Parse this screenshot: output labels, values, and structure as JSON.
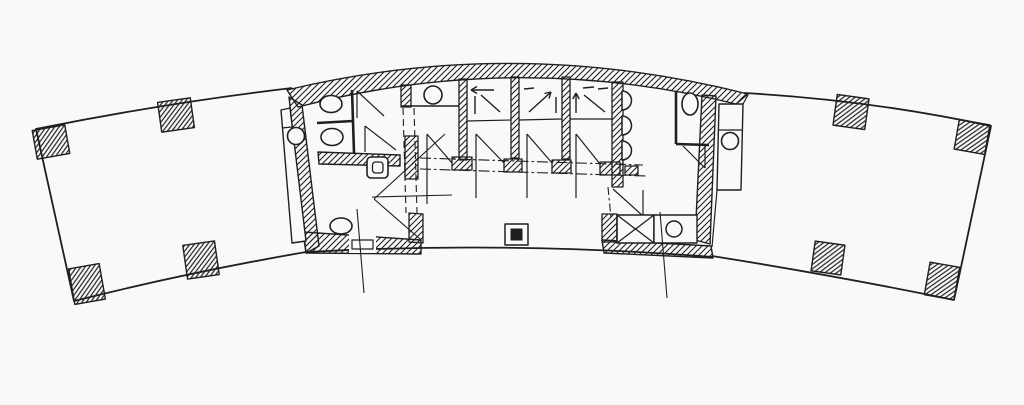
{
  "meta": {
    "type": "architectural-floor-plan",
    "description": "Hand-drafted scanned floor plan of a curved arc-shaped building: open east and west wings with hatched structural columns, and a central service core containing toilet rooms, three elevators with directional arrows, urinals, a duct shaft and service closets.",
    "canvas": {
      "width": 1024,
      "height": 405
    },
    "colors": {
      "ink": "#1f1f1f",
      "paper": "#f9f9f7"
    }
  },
  "legend": {
    "wing_columns": 8,
    "round_columns": 2,
    "elevators": 3,
    "toilets": 4,
    "urinals": 3,
    "basins": 2,
    "duct_shafts": 1,
    "closets": 1
  },
  "shapes": [
    {
      "name": "left-wing-outline",
      "kind": "path",
      "d": "M292,88 Q165,103 36,129 L74,301 Q190,272 306,252",
      "sw": 1.8
    },
    {
      "name": "right-wing-outline",
      "kind": "path",
      "d": "M744,93 Q870,100 991,126 L954,300 Q838,276 712,256",
      "sw": 1.8
    },
    {
      "name": "building-south-edge",
      "kind": "path",
      "d": "M306,252 Q510,241 713,257",
      "sw": 1.8
    },
    {
      "name": "structural-column",
      "kind": "rect",
      "x": 34.5,
      "y": 127.5,
      "w": 33,
      "h": 29,
      "rot": -10,
      "fill": "hatch2",
      "sw": 1.4
    },
    {
      "name": "structural-column",
      "kind": "rect",
      "x": 159.5,
      "y": 100,
      "w": 33,
      "h": 30,
      "rot": -8,
      "fill": "hatch2",
      "sw": 1.4
    },
    {
      "name": "structural-column",
      "kind": "rect",
      "x": 71.5,
      "y": 266,
      "w": 31,
      "h": 36,
      "rot": -10,
      "fill": "hatch2",
      "sw": 1.4
    },
    {
      "name": "structural-column",
      "kind": "rect",
      "x": 185,
      "y": 243,
      "w": 32,
      "h": 34,
      "rot": -8,
      "fill": "hatch2",
      "sw": 1.4
    },
    {
      "name": "structural-column",
      "kind": "rect",
      "x": 835,
      "y": 96.5,
      "w": 32,
      "h": 31,
      "rot": 8,
      "fill": "hatch2",
      "sw": 1.4
    },
    {
      "name": "structural-column",
      "kind": "rect",
      "x": 956.5,
      "y": 122,
      "w": 31,
      "h": 30,
      "rot": 10,
      "fill": "hatch2",
      "sw": 1.4
    },
    {
      "name": "structural-column",
      "kind": "rect",
      "x": 813,
      "y": 243,
      "w": 30,
      "h": 30,
      "rot": 8,
      "fill": "hatch2",
      "sw": 1.4
    },
    {
      "name": "structural-column",
      "kind": "rect",
      "x": 927,
      "y": 264.5,
      "w": 30,
      "h": 33,
      "rot": 10,
      "fill": "hatch2",
      "sw": 1.4
    },
    {
      "name": "core-north-wall",
      "kind": "path",
      "d": "M287,90 Q515,35 748,94 L736,104 Q515,50 298,107 Z",
      "fill": "hatch",
      "sw": 1.4
    },
    {
      "name": "core-west-wall",
      "kind": "path",
      "d": "M289,97 L302,105 L319,246 L306,253 Z",
      "fill": "hatch",
      "sw": 1.4
    },
    {
      "name": "core-east-wall",
      "kind": "path",
      "d": "M702,95 L716,96 L710,244 L695,240 Z",
      "fill": "hatch",
      "sw": 1.4
    },
    {
      "name": "core-south-wall-west",
      "kind": "path",
      "d": "M303,232 L421,240 L421,254 L306,253 Z",
      "fill": "hatch",
      "sw": 1.4
    },
    {
      "name": "core-south-wall-east",
      "kind": "path",
      "d": "M602,240 L711,246 L713,258 L604,253 Z",
      "fill": "hatch",
      "sw": 1.4
    },
    {
      "name": "wc-partition-wall",
      "kind": "path",
      "d": "M318,152 L400,155 L400,166 L319,164 Z",
      "fill": "hatch",
      "sw": 1.4
    },
    {
      "name": "pier-service-room",
      "kind": "path",
      "d": "M401,85 L411,85 L411,107 L401,107 Z",
      "fill": "hatch",
      "sw": 1.3
    },
    {
      "name": "pier-lobby-west",
      "kind": "path",
      "d": "M405,136 L418,136 L418,179 L405,179 Z",
      "fill": "hatch",
      "sw": 1.3
    },
    {
      "name": "pier-lobby-south",
      "kind": "path",
      "d": "M409,213 L423,214 L423,243 L409,242 Z",
      "fill": "hatch",
      "sw": 1.3
    },
    {
      "name": "elevator-pier",
      "kind": "rect",
      "x": 459,
      "y": 79,
      "w": 8,
      "h": 81,
      "fill": "hatch",
      "sw": 1.3
    },
    {
      "name": "elevator-pier",
      "kind": "rect",
      "x": 511,
      "y": 77,
      "w": 8,
      "h": 81,
      "fill": "hatch",
      "sw": 1.3
    },
    {
      "name": "elevator-pier",
      "kind": "rect",
      "x": 562,
      "y": 77,
      "w": 8,
      "h": 82,
      "fill": "hatch",
      "sw": 1.3
    },
    {
      "name": "mens-west-wall",
      "kind": "rect",
      "x": 612,
      "y": 82,
      "w": 11,
      "h": 105,
      "fill": "hatch",
      "sw": 1.3
    },
    {
      "name": "pier-duct",
      "kind": "rect",
      "x": 602,
      "y": 214,
      "w": 15,
      "h": 28,
      "fill": "hatch",
      "sw": 1.3
    },
    {
      "name": "door-gap",
      "kind": "rect",
      "x": 349,
      "y": 231,
      "w": 27,
      "h": 22,
      "fill": "paper"
    },
    {
      "name": "door-threshold",
      "kind": "rect",
      "x": 352,
      "y": 240,
      "w": 21,
      "h": 9,
      "fill": "paper",
      "sw": 1.2
    },
    {
      "name": "west-service-strip",
      "kind": "path",
      "d": "M281,110 L290,108 L306,241 L292,243 Z",
      "fill": "paper",
      "sw": 1.4
    },
    {
      "name": "west-strip-divider",
      "kind": "line",
      "x1": 282,
      "y1": 128,
      "x2": 292,
      "y2": 127,
      "sw": 1.2
    },
    {
      "name": "east-service-strip",
      "kind": "path",
      "d": "M719,104 L743,104 L741,190 L717,190 Z",
      "fill": "paper",
      "sw": 1.4
    },
    {
      "name": "east-strip-divider",
      "kind": "line",
      "x1": 719,
      "y1": 130,
      "x2": 742,
      "y2": 130,
      "sw": 1.2
    },
    {
      "name": "east-strip-top-link",
      "kind": "line",
      "x1": 743,
      "y1": 104,
      "x2": 748,
      "y2": 95,
      "sw": 1.2
    },
    {
      "name": "east-strip-bottom-link",
      "kind": "line",
      "x1": 717,
      "y1": 190,
      "x2": 712,
      "y2": 247,
      "sw": 1.2
    },
    {
      "name": "round-column",
      "kind": "circle",
      "cx": 296,
      "cy": 136,
      "r": 8.5,
      "fill": "paper",
      "sw": 1.6
    },
    {
      "name": "round-column",
      "kind": "circle",
      "cx": 730,
      "cy": 141,
      "r": 8.5,
      "fill": "paper",
      "sw": 1.6
    },
    {
      "name": "stall-front-partition",
      "kind": "line",
      "x1": 352,
      "y1": 90,
      "x2": 354,
      "y2": 153,
      "sw": 2.6
    },
    {
      "name": "stall-partition",
      "kind": "line",
      "x1": 317,
      "y1": 123,
      "x2": 353,
      "y2": 121,
      "sw": 2.6
    },
    {
      "name": "toilet",
      "kind": "ellipse",
      "cx": 331,
      "cy": 104,
      "rx": 11,
      "ry": 8.5,
      "fill": "paper",
      "sw": 1.6
    },
    {
      "name": "toilet",
      "kind": "ellipse",
      "cx": 332,
      "cy": 137,
      "rx": 11,
      "ry": 8.5,
      "fill": "paper",
      "sw": 1.6
    },
    {
      "name": "door-leaf",
      "kind": "line",
      "x1": 357,
      "y1": 91,
      "x2": 357,
      "y2": 118,
      "sw": 1.2
    },
    {
      "name": "door-swing",
      "kind": "line",
      "x1": 357,
      "y1": 91,
      "x2": 384,
      "y2": 116,
      "sw": 1.2
    },
    {
      "name": "door-leaf",
      "kind": "line",
      "x1": 365,
      "y1": 126,
      "x2": 365,
      "y2": 152,
      "sw": 1.2
    },
    {
      "name": "door-swing",
      "kind": "line",
      "x1": 365,
      "y1": 126,
      "x2": 396,
      "y2": 150,
      "sw": 1.2
    },
    {
      "name": "mop-sink",
      "kind": "rect",
      "x": 367,
      "y": 157,
      "w": 21,
      "h": 21,
      "rx": 4,
      "fill": "paper",
      "sw": 1.6
    },
    {
      "name": "mop-sink-basin",
      "kind": "rect",
      "x": 372.5,
      "y": 162,
      "w": 10.5,
      "h": 11,
      "rx": 3,
      "sw": 1.3
    },
    {
      "name": "accessible-toilet",
      "kind": "ellipse",
      "cx": 341,
      "cy": 226,
      "rx": 11,
      "ry": 8,
      "fill": "paper",
      "sw": 1.6
    },
    {
      "name": "service-room-wall",
      "kind": "line",
      "x1": 401,
      "y1": 106,
      "x2": 459,
      "y2": 106,
      "sw": 1.4
    },
    {
      "name": "wash-basin",
      "kind": "circle",
      "cx": 433,
      "cy": 95,
      "r": 9,
      "fill": "paper",
      "sw": 1.6
    },
    {
      "name": "elevator-car-line",
      "kind": "line",
      "x1": 467,
      "y1": 121,
      "x2": 511,
      "y2": 120,
      "sw": 1.2
    },
    {
      "name": "elevator-car-line",
      "kind": "line",
      "x1": 519,
      "y1": 120,
      "x2": 562,
      "y2": 119,
      "sw": 1.2
    },
    {
      "name": "elevator-car-line",
      "kind": "line",
      "x1": 570,
      "y1": 119,
      "x2": 612,
      "y2": 119,
      "sw": 1.2
    },
    {
      "name": "elevator-arrow",
      "kind": "line",
      "x1": 494,
      "y1": 90,
      "x2": 471,
      "y2": 90,
      "sw": 1.4
    },
    {
      "name": "elevator-arrow-head",
      "kind": "path",
      "d": "M471,90 L477,86.5 M471,90 L477,93.5",
      "sw": 1.4
    },
    {
      "name": "elevator-arrow",
      "kind": "line",
      "x1": 475,
      "y1": 96,
      "x2": 475,
      "y2": 114,
      "sw": 1.4
    },
    {
      "name": "elevator-arrow",
      "kind": "line",
      "x1": 481,
      "y1": 95,
      "x2": 500,
      "y2": 112,
      "sw": 1.4
    },
    {
      "name": "elevator-arrow",
      "kind": "line",
      "x1": 524,
      "y1": 89,
      "x2": 534,
      "y2": 88,
      "sw": 1.4
    },
    {
      "name": "elevator-arrow",
      "kind": "line",
      "x1": 529,
      "y1": 112,
      "x2": 551,
      "y2": 92,
      "sw": 1.4
    },
    {
      "name": "elevator-arrow-head",
      "kind": "path",
      "d": "M551,92 L544.5,93.5 M551,92 L549,98.5",
      "sw": 1.4
    },
    {
      "name": "elevator-arrow",
      "kind": "line",
      "x1": 556,
      "y1": 97,
      "x2": 556,
      "y2": 113,
      "sw": 1.4
    },
    {
      "name": "elevator-arrow",
      "kind": "line",
      "x1": 576,
      "y1": 93,
      "x2": 576,
      "y2": 113,
      "sw": 1.4
    },
    {
      "name": "elevator-arrow-head",
      "kind": "path",
      "d": "M576,93 L572.8,99 M576,93 L579.2,99",
      "sw": 1.4
    },
    {
      "name": "elevator-arrow",
      "kind": "line",
      "x1": 583,
      "y1": 88,
      "x2": 594,
      "y2": 87,
      "sw": 1.4
    },
    {
      "name": "elevator-arrow",
      "kind": "line",
      "x1": 584,
      "y1": 95,
      "x2": 605,
      "y2": 112,
      "sw": 1.4
    },
    {
      "name": "elevator-arrow",
      "kind": "line",
      "x1": 598,
      "y1": 89,
      "x2": 608,
      "y2": 88,
      "sw": 1.4
    },
    {
      "name": "dashed-overhead-line",
      "kind": "line",
      "x1": 403,
      "y1": 108,
      "x2": 406,
      "y2": 213,
      "dash": "7 4",
      "sw": 1.1
    },
    {
      "name": "dashed-overhead-line",
      "kind": "line",
      "x1": 414,
      "y1": 108,
      "x2": 417,
      "y2": 213,
      "dash": "7 4",
      "sw": 1.1
    },
    {
      "name": "dashdot-line",
      "kind": "line",
      "x1": 420,
      "y1": 158,
      "x2": 643,
      "y2": 165,
      "dash": "11 3 2.5 3",
      "sw": 1.1
    },
    {
      "name": "dashdot-line",
      "kind": "line",
      "x1": 420,
      "y1": 169,
      "x2": 646,
      "y2": 176,
      "dash": "11 3 2.5 3",
      "sw": 1.1
    },
    {
      "name": "dashdot-line",
      "kind": "line",
      "x1": 608,
      "y1": 187,
      "x2": 611,
      "y2": 218,
      "dash": "8 3 2.5 3",
      "sw": 1.1
    },
    {
      "name": "door-jamb",
      "kind": "rect",
      "x": 452,
      "y": 157,
      "w": 20,
      "h": 13,
      "fill": "hatch",
      "sw": 1.3
    },
    {
      "name": "door-jamb",
      "kind": "rect",
      "x": 504,
      "y": 159,
      "w": 18,
      "h": 13,
      "fill": "hatch",
      "sw": 1.3
    },
    {
      "name": "door-jamb",
      "kind": "rect",
      "x": 552,
      "y": 160,
      "w": 19,
      "h": 13,
      "fill": "hatch",
      "sw": 1.3
    },
    {
      "name": "door-jamb",
      "kind": "rect",
      "x": 600,
      "y": 162,
      "w": 20,
      "h": 13,
      "fill": "hatch",
      "sw": 1.3
    },
    {
      "name": "wall-return",
      "kind": "rect",
      "x": 625,
      "y": 166,
      "w": 13,
      "h": 9,
      "fill": "hatch",
      "sw": 1.3
    },
    {
      "name": "lobby-door-leaf",
      "kind": "line",
      "x1": 427,
      "y1": 134,
      "x2": 427,
      "y2": 204,
      "sw": 1.2
    },
    {
      "name": "lobby-door-swing",
      "kind": "line",
      "x1": 427,
      "y1": 134,
      "x2": 452,
      "y2": 163,
      "sw": 1.2
    },
    {
      "name": "elevator-door-leaf",
      "kind": "line",
      "x1": 476,
      "y1": 134,
      "x2": 476,
      "y2": 198,
      "sw": 1.2
    },
    {
      "name": "elevator-door-swing",
      "kind": "line",
      "x1": 476,
      "y1": 134,
      "x2": 504,
      "y2": 163,
      "sw": 1.2
    },
    {
      "name": "elevator-door-leaf",
      "kind": "line",
      "x1": 527,
      "y1": 134,
      "x2": 527,
      "y2": 198,
      "sw": 1.2
    },
    {
      "name": "elevator-door-swing",
      "kind": "line",
      "x1": 527,
      "y1": 134,
      "x2": 552,
      "y2": 163,
      "sw": 1.2
    },
    {
      "name": "elevator-door-leaf",
      "kind": "line",
      "x1": 576,
      "y1": 134,
      "x2": 576,
      "y2": 198,
      "sw": 1.2
    },
    {
      "name": "elevator-door-swing",
      "kind": "line",
      "x1": 576,
      "y1": 134,
      "x2": 600,
      "y2": 164,
      "sw": 1.2
    },
    {
      "name": "construction-line",
      "kind": "line",
      "x1": 372,
      "y1": 197,
      "x2": 452,
      "y2": 195,
      "sw": 1.1
    },
    {
      "name": "construction-line",
      "kind": "line",
      "x1": 374,
      "y1": 199,
      "x2": 445,
      "y2": 134,
      "sw": 1.1
    },
    {
      "name": "construction-line",
      "kind": "line",
      "x1": 374,
      "y1": 199,
      "x2": 420,
      "y2": 239,
      "sw": 1.1
    },
    {
      "name": "urinal",
      "kind": "path",
      "d": "M622,91 A9.5,9.5 0 0 1 622,110 Z",
      "fill": "paper",
      "sw": 1.5
    },
    {
      "name": "urinal",
      "kind": "path",
      "d": "M622,116 A9.5,9.5 0 0 1 622,135 Z",
      "fill": "paper",
      "sw": 1.5
    },
    {
      "name": "urinal",
      "kind": "path",
      "d": "M622,141 A9.5,9.5 0 0 1 622,160 Z",
      "fill": "paper",
      "sw": 1.5
    },
    {
      "name": "stall-partition",
      "kind": "line",
      "x1": 676,
      "y1": 92,
      "x2": 676,
      "y2": 144,
      "sw": 2.6
    },
    {
      "name": "stall-partition",
      "kind": "line",
      "x1": 676,
      "y1": 144,
      "x2": 709,
      "y2": 145,
      "sw": 2.6
    },
    {
      "name": "toilet",
      "kind": "ellipse",
      "cx": 690,
      "cy": 104,
      "rx": 8,
      "ry": 11,
      "fill": "paper",
      "sw": 1.6
    },
    {
      "name": "door-leaf",
      "kind": "line",
      "x1": 705,
      "y1": 146,
      "x2": 705,
      "y2": 168,
      "sw": 1.2
    },
    {
      "name": "door-swing",
      "kind": "line",
      "x1": 683,
      "y1": 146,
      "x2": 705,
      "y2": 168,
      "sw": 1.2
    },
    {
      "name": "door-swing",
      "kind": "line",
      "x1": 613,
      "y1": 189,
      "x2": 643,
      "y2": 216,
      "sw": 1.2
    },
    {
      "name": "door-leaf",
      "kind": "line",
      "x1": 643,
      "y1": 190,
      "x2": 643,
      "y2": 216,
      "sw": 1.2
    },
    {
      "name": "duct-shaft",
      "kind": "rect",
      "x": 617,
      "y": 215,
      "w": 37,
      "h": 28,
      "fill": "paper",
      "sw": 1.6
    },
    {
      "name": "duct-shaft-cross",
      "kind": "line",
      "x1": 617,
      "y1": 215,
      "x2": 654,
      "y2": 243,
      "sw": 1.3
    },
    {
      "name": "duct-shaft-cross",
      "kind": "line",
      "x1": 654,
      "y1": 215,
      "x2": 617,
      "y2": 243,
      "sw": 1.3
    },
    {
      "name": "service-closet",
      "kind": "rect",
      "x": 654,
      "y": 215,
      "w": 43,
      "h": 28,
      "fill": "paper",
      "sw": 1.4
    },
    {
      "name": "closet-drain",
      "kind": "circle",
      "cx": 674,
      "cy": 229,
      "r": 8,
      "sw": 1.5
    },
    {
      "name": "floor-marker-outer",
      "kind": "rect",
      "x": 505,
      "y": 224,
      "w": 23,
      "h": 21,
      "fill": "paper",
      "sw": 1.5
    },
    {
      "name": "floor-marker-inner",
      "kind": "rect",
      "x": 510.5,
      "y": 228.5,
      "w": 12,
      "h": 12,
      "fill": "ink"
    },
    {
      "name": "grid-line",
      "kind": "line",
      "x1": 357,
      "y1": 209,
      "x2": 364,
      "y2": 293,
      "sw": 1.1
    },
    {
      "name": "grid-line",
      "kind": "line",
      "x1": 660,
      "y1": 212,
      "x2": 667,
      "y2": 298,
      "sw": 1.1
    }
  ]
}
